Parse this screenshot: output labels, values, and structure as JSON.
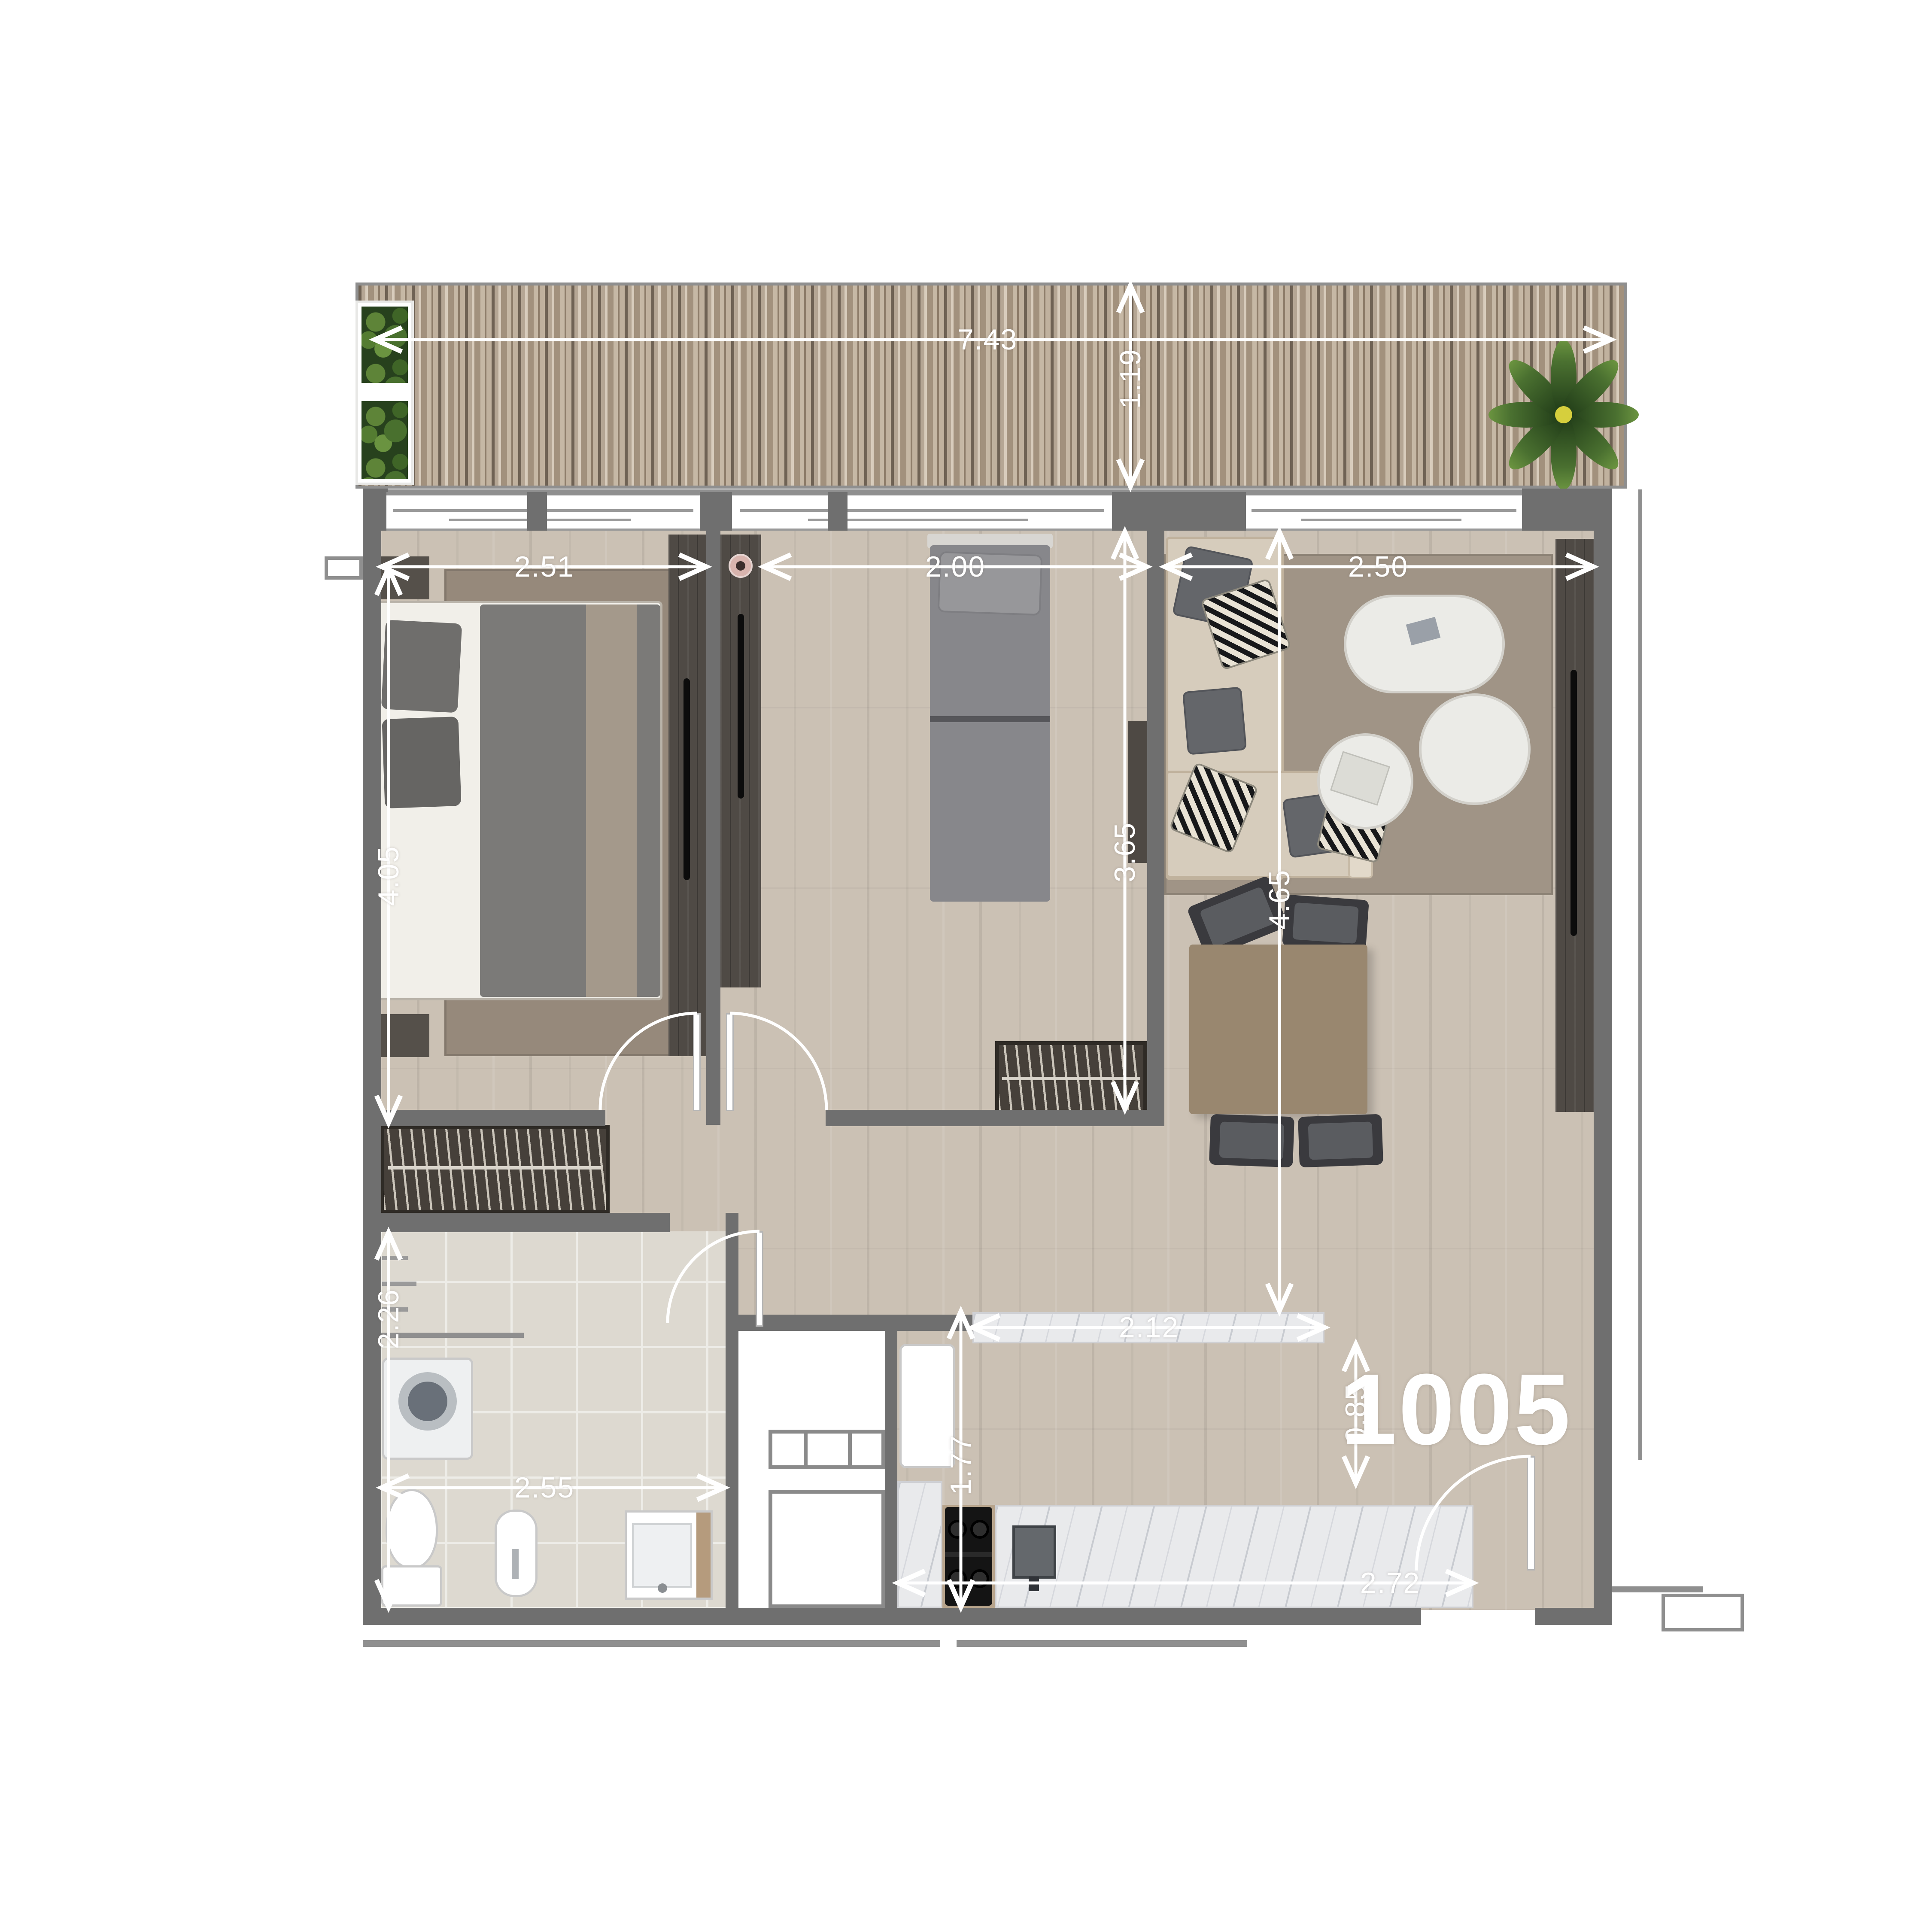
{
  "unit": {
    "number": "1005"
  },
  "dims": {
    "deck_width": "7.43",
    "deck_depth": "1.19",
    "bedroom1_width": "2.51",
    "bedroom2_width": "2.00",
    "living_width": "2.50",
    "bedroom1_depth": "4.05",
    "bedroom2_depth": "3.65",
    "living_depth": "4.65",
    "bathroom_depth": "2.26",
    "bathroom_width": "2.55",
    "kitchen_counter_width": "2.12",
    "kitchen_depth": "1.77",
    "kitchen_pass_depth": "0.85",
    "kitchen_width": "2.72"
  },
  "colors": {
    "wall": "#6f6f6f",
    "dimension": "#ffffff",
    "deck_wood": "#b3a392",
    "floor_wood": "#cbc1b4",
    "bath_tile": "#ddd9d0",
    "marble": "#e9eaec",
    "dark_furniture": "#4f4a45",
    "sofa": "#d6ccbc",
    "plant_green": "#3c5a2a"
  }
}
